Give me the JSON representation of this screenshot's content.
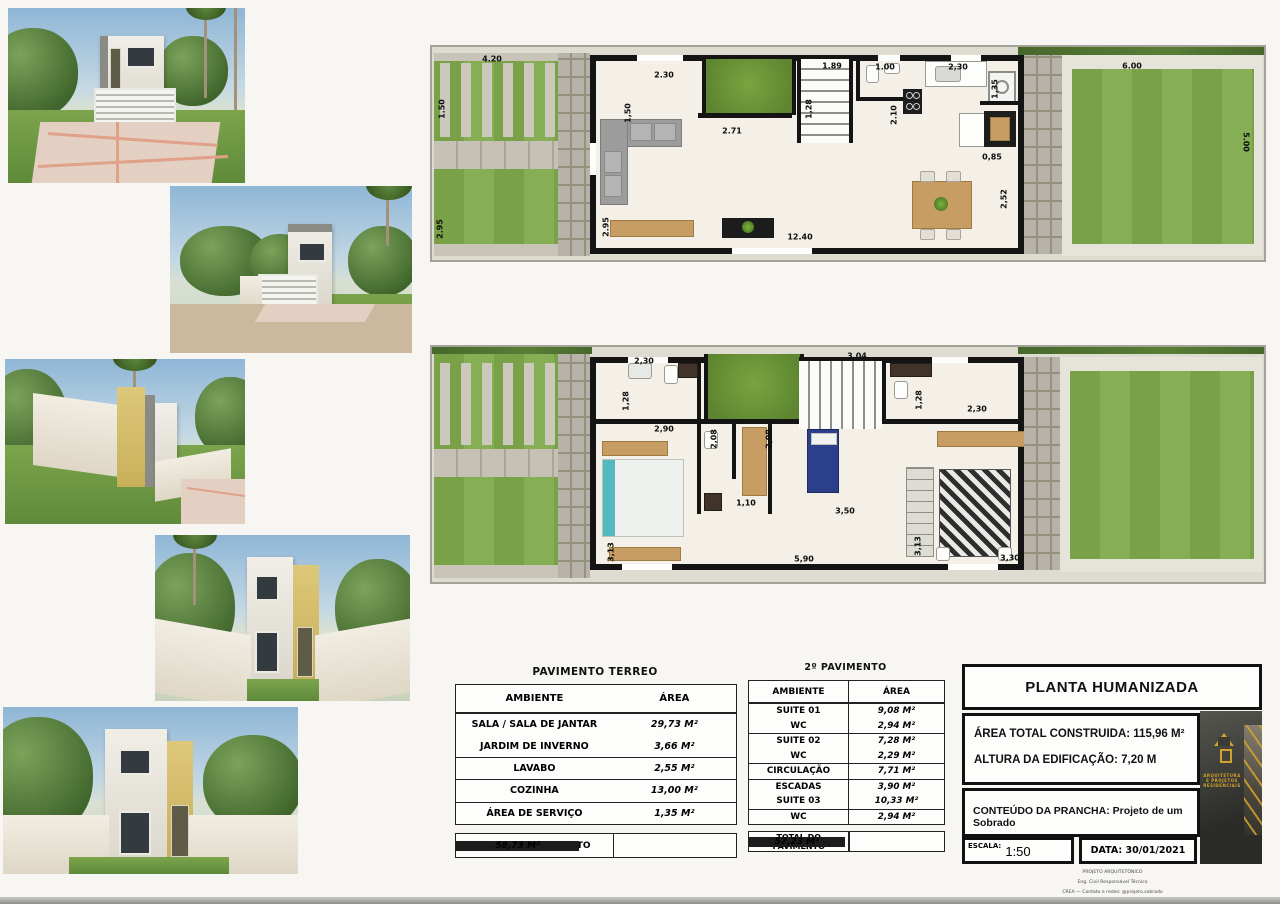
{
  "photos": [
    {
      "name": "render-front-facade"
    },
    {
      "name": "render-front-perspective"
    },
    {
      "name": "render-side-view"
    },
    {
      "name": "render-backyard-view"
    },
    {
      "name": "render-rear-view"
    }
  ],
  "plans": {
    "terreo": {
      "dims": [
        {
          "t": "4.20",
          "x": 60,
          "y": 12
        },
        {
          "t": "1.50",
          "x": 10,
          "y": 62,
          "r": -90
        },
        {
          "t": "2.95",
          "x": 8,
          "y": 182,
          "r": -90
        },
        {
          "t": "2.30",
          "x": 232,
          "y": 28
        },
        {
          "t": "1,50",
          "x": 196,
          "y": 66,
          "r": -90
        },
        {
          "t": "2.71",
          "x": 300,
          "y": 84
        },
        {
          "t": "1.89",
          "x": 400,
          "y": 19
        },
        {
          "t": "1,28",
          "x": 377,
          "y": 62,
          "r": -90
        },
        {
          "t": "1.00",
          "x": 453,
          "y": 20
        },
        {
          "t": "2,30",
          "x": 526,
          "y": 20
        },
        {
          "t": "2.10",
          "x": 462,
          "y": 68,
          "r": -90
        },
        {
          "t": "1,35",
          "x": 563,
          "y": 42,
          "r": -90
        },
        {
          "t": "0,85",
          "x": 560,
          "y": 110
        },
        {
          "t": "2,52",
          "x": 572,
          "y": 152,
          "r": -90
        },
        {
          "t": "2.95",
          "x": 174,
          "y": 180,
          "r": -90
        },
        {
          "t": "12.40",
          "x": 368,
          "y": 190
        },
        {
          "t": "6.00",
          "x": 700,
          "y": 19
        },
        {
          "t": "5.00",
          "x": 814,
          "y": 95,
          "r": 90
        }
      ]
    },
    "pav2": {
      "dims": [
        {
          "t": "2,30",
          "x": 212,
          "y": 14
        },
        {
          "t": "1,28",
          "x": 194,
          "y": 54,
          "r": -90
        },
        {
          "t": "2,90",
          "x": 232,
          "y": 82
        },
        {
          "t": "2,08",
          "x": 282,
          "y": 92,
          "r": -90
        },
        {
          "t": "2,08",
          "x": 337,
          "y": 92,
          "r": -90
        },
        {
          "t": "1,10",
          "x": 314,
          "y": 156
        },
        {
          "t": "3,13",
          "x": 179,
          "y": 205,
          "r": -90
        },
        {
          "t": "5,90",
          "x": 372,
          "y": 212
        },
        {
          "t": "3,04",
          "x": 425,
          "y": 9
        },
        {
          "t": "1,28",
          "x": 487,
          "y": 53,
          "r": -90
        },
        {
          "t": "2,30",
          "x": 545,
          "y": 62
        },
        {
          "t": "3,50",
          "x": 413,
          "y": 164
        },
        {
          "t": "3,13",
          "x": 486,
          "y": 199,
          "r": -90
        },
        {
          "t": "3,30",
          "x": 578,
          "y": 211
        }
      ]
    }
  },
  "tables": {
    "terreo": {
      "title": "PAVIMENTO TERREO",
      "col_ambiente": "AMBIENTE",
      "col_area": "ÁREA",
      "rows": [
        {
          "ambiente": "SALA / SALA DE JANTAR",
          "area": "29,73 M²"
        },
        {
          "ambiente": "JARDIM DE INVERNO",
          "area": "3,66 M²"
        },
        {
          "ambiente": "LAVABO",
          "area": "2,55 M²",
          "sep": true
        },
        {
          "ambiente": "COZINHA",
          "area": "13,00 M²",
          "sep": true
        },
        {
          "ambiente": "ÁREA DE SERVIÇO",
          "area": "1,35 M²",
          "sep": true
        }
      ],
      "total_label": "TOTAL DO PAVIMENTO",
      "total_value": "58,73 M²"
    },
    "pav2": {
      "title": "2º PAVIMENTO",
      "col_ambiente": "AMBIENTE",
      "col_area": "ÁREA",
      "rows": [
        {
          "ambiente": "SUITE 01",
          "area": "9,08 M²"
        },
        {
          "ambiente": "WC",
          "area": "2,94 M²"
        },
        {
          "ambiente": "SUITE 02",
          "area": "7,28 M²",
          "sep": true
        },
        {
          "ambiente": "WC",
          "area": "2,29 M²"
        },
        {
          "ambiente": "CIRCULAÇÃO",
          "area": "7,71 M²",
          "sep": true
        },
        {
          "ambiente": "ESCADAS",
          "area": "3,90 M²",
          "sep": true
        },
        {
          "ambiente": "SUITE 03",
          "area": "10,33 M²"
        },
        {
          "ambiente": "WC",
          "area": "2,94 M²",
          "sep": true
        }
      ],
      "total_label": "TOTAL DO PAVIMENTO",
      "total_value": "57,23 M²"
    }
  },
  "titleblock": {
    "title": "PLANTA HUMANIZADA",
    "area_total": "ÁREA TOTAL CONSTRUIDA: 115,96 M²",
    "altura": "ALTURA DA EDIFICAÇÃO: 7,20 M",
    "conteudo_label": "CONTEÚDO DA PRANCHA:",
    "conteudo_value": "Projeto de um Sobrado",
    "escala_label": "ESCALA:",
    "escala_value": "1:50",
    "data_value": "DATA: 30/01/2021",
    "footer_lines": [
      {
        "t": "PROJETO ARQUITETÔNICO"
      },
      {
        "t": "Eng. Civil Responsável Técnico"
      },
      {
        "t": "CREA — Contato e redes: @projeto.sobrado"
      }
    ]
  }
}
